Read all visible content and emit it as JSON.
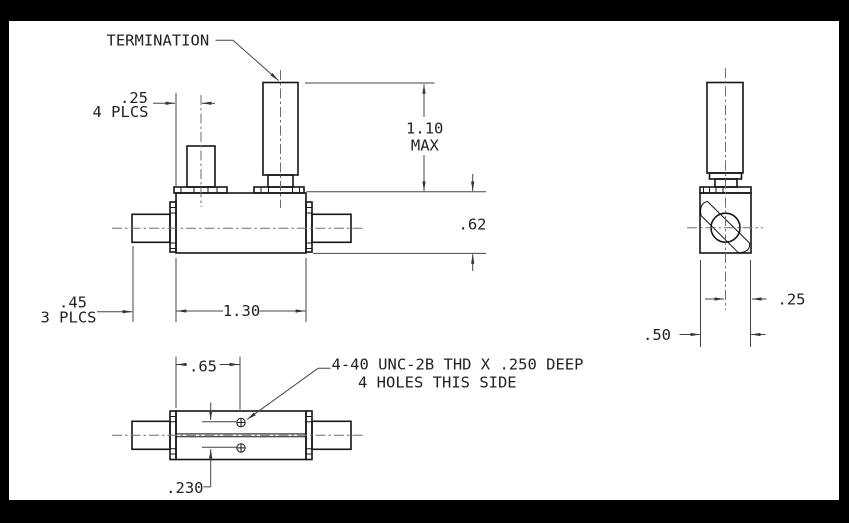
{
  "drawing": {
    "title_note": "TERMINATION",
    "thread_note": {
      "line1": "4-40 UNC-2B THD X .250 DEEP",
      "line2": "4 HOLES THIS SIDE"
    },
    "dimensions": {
      "connector_offset_value": ".25",
      "connector_offset_qualifier": "4 PLCS",
      "height_max_value": "1.10",
      "height_max_qualifier": "MAX",
      "body_height": ".62",
      "connector_length_value": ".45",
      "connector_length_qualifier": "3 PLCS",
      "body_length": "1.30",
      "hole_offset_x": ".65",
      "hole_spacing": ".230",
      "side_center_to_edge": ".25",
      "side_width": ".50"
    },
    "colors": {
      "background": "#000000",
      "paper": "#ffffff",
      "object_line": "#161616",
      "dimension_line": "#454545",
      "centerline": "#6e6e6e"
    }
  }
}
